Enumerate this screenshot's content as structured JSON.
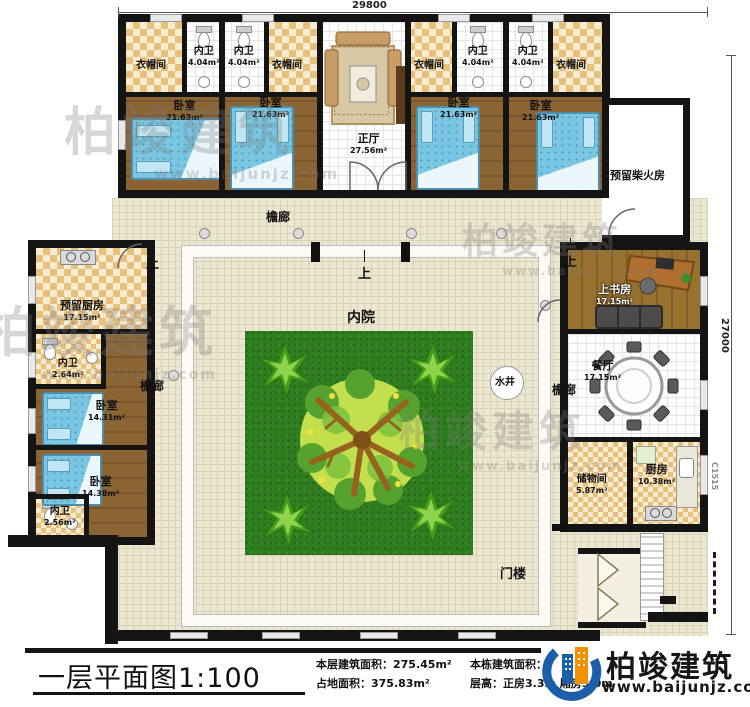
{
  "dimensions": {
    "top": "29800",
    "right": "27000",
    "window_code": "C1515"
  },
  "north": {
    "closet": "衣帽间",
    "bath": "内卫",
    "bath_area": "4.04m²",
    "bedroom": "卧室",
    "bedroom_area": "21.63m²",
    "hall": "正厅",
    "hall_area": "27.56m²"
  },
  "west": {
    "kitchen": "预留厨房",
    "kitchen_area": "17.15m²",
    "bath1": "内卫",
    "bath1_area": "2.64m²",
    "bed1": "卧室",
    "bed1_area": "14.31m²",
    "bed2": "卧室",
    "bed2_area": "14.38m²",
    "bath2": "内卫",
    "bath2_area": "2.56m²"
  },
  "east": {
    "study": "上书房",
    "study_area": "17.15m²",
    "dining": "餐厅",
    "dining_area": "17.15m²",
    "storage": "储物间",
    "storage_area": "5.87m²",
    "kitchen": "厨房",
    "kitchen_area": "10.38m²"
  },
  "court": {
    "yard": "内院",
    "well": "水井",
    "corridor": "檐廊",
    "up": "上",
    "firewood": "预留柴火房",
    "gate": "门楼"
  },
  "titleblock": {
    "title": "一层平面图1:100",
    "floor_area": "本层建筑面积：275.45m²",
    "land_area": "占地面积：375.83m²",
    "building_area": "本栋建筑面积：",
    "height": "层高：正房3.3m  厢房3.0m"
  },
  "logo": {
    "name": "柏竣建筑",
    "url": "www.baijunjz.com"
  },
  "watermark": {
    "name": "柏竣建筑",
    "url": "www.baijunjz.com"
  },
  "colors": {
    "wall": "#141414",
    "wood": "#8a6433",
    "tile": "#ece7d1",
    "grass": "#2e7d1e",
    "checker": "#e7c07c",
    "bed": "#79c7e3",
    "logo_blue": "#1c5fa8",
    "logo_orange": "#f29200"
  }
}
